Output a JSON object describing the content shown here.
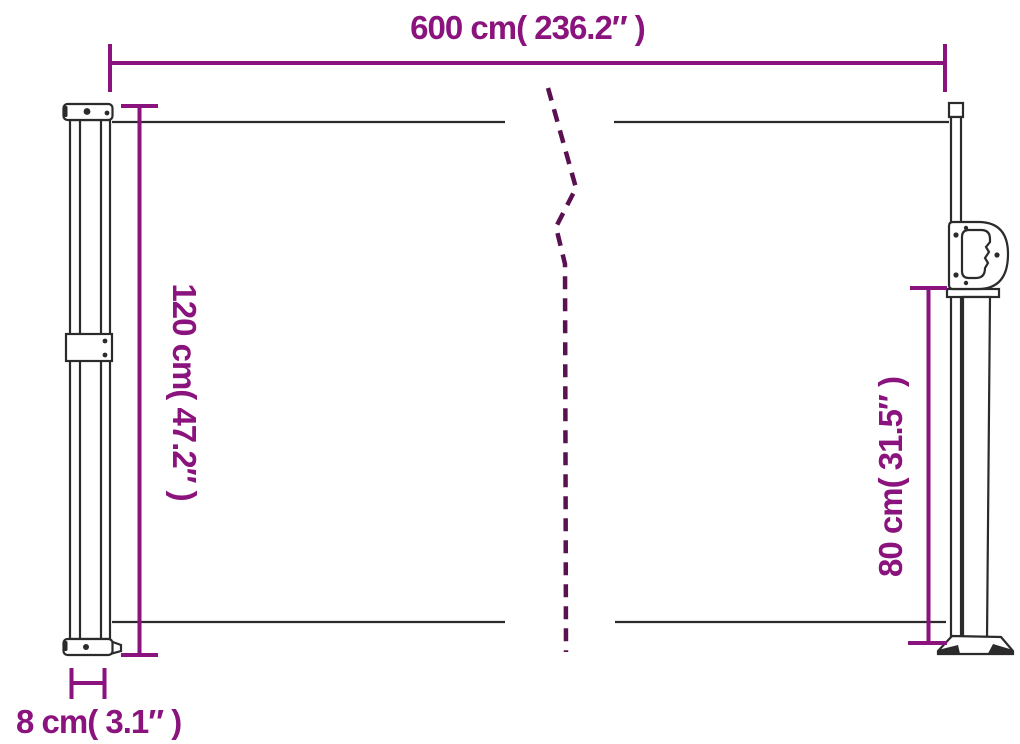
{
  "colors": {
    "dimension-color": "#8A137D",
    "break-line-color": "#5A1150",
    "drawing-color": "#2B2B2B",
    "background-color": "#FFFFFF"
  },
  "dimensions": {
    "overall_width": {
      "label": "600 cm( 236.2″ )",
      "cm": 600,
      "inches": 236.2
    },
    "cassette_height": {
      "label": "120 cm( 47.2″ )",
      "cm": 120,
      "inches": 47.2
    },
    "pole_height": {
      "label": "80 cm( 31.5″ )",
      "cm": 80,
      "inches": 31.5
    },
    "cassette_depth": {
      "label": "8 cm( 3.1″ )",
      "cm": 8,
      "inches": 3.1
    }
  }
}
